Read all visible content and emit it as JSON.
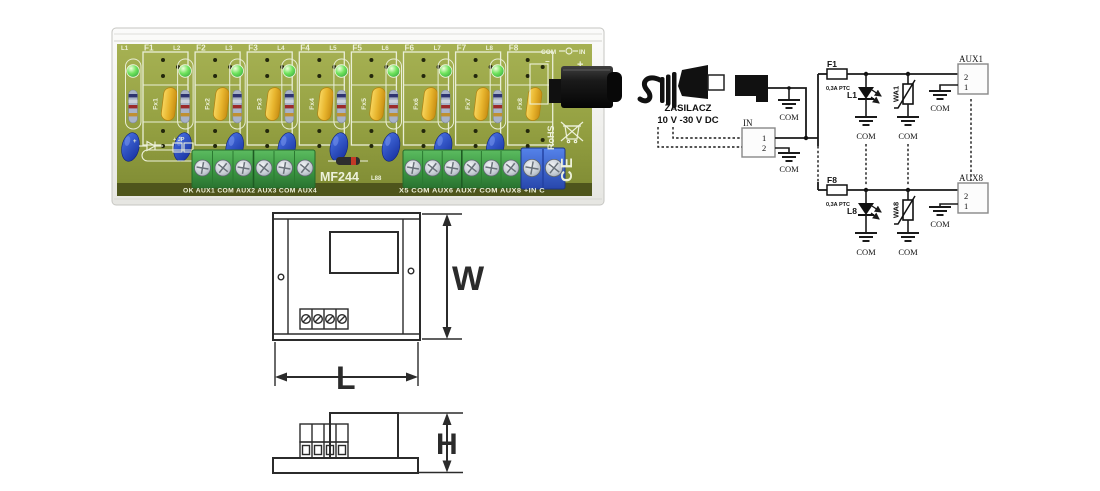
{
  "pcb": {
    "channels": [
      {
        "f": "F1",
        "l": "L1",
        "fx": "Fx1"
      },
      {
        "f": "F2",
        "l": "L2",
        "fx": "Fx2"
      },
      {
        "f": "F3",
        "l": "L3",
        "fx": "Fx3"
      },
      {
        "f": "F4",
        "l": "L4",
        "fx": "Fx4"
      },
      {
        "f": "F5",
        "l": "L5",
        "fx": "Fx5"
      },
      {
        "f": "F6",
        "l": "L6",
        "fx": "Fx6"
      },
      {
        "f": "F7",
        "l": "L7",
        "fx": "Fx7"
      },
      {
        "f": "F8",
        "l": "L8",
        "fx": "Fx8"
      }
    ],
    "power_header": {
      "com": "COM",
      "in": "IN",
      "minus": "−",
      "plus": "+"
    },
    "silk_left_labels": "OK AUX1 COM AUX2 AUX3 COM AUX4",
    "silk_right_labels": "X5 COM AUX6 AUX7 COM AUX8 +IN C",
    "model": "MF244",
    "code": "L88",
    "jumper_label": "+ JP",
    "diode_plus": "+",
    "rohs": "RoHS",
    "ce_mark": "CE"
  },
  "dimensions": {
    "width_label": "W",
    "length_label": "L",
    "height_label": "H"
  },
  "schematic": {
    "psu_line1": "ZASILACZ",
    "psu_line2": "10 V -30 V DC",
    "in_label": "IN",
    "in_pin1": "1",
    "in_pin2": "2",
    "com": "COM",
    "branch1": {
      "fuse": "F1",
      "rating": "0,3A PTC",
      "led": "L1",
      "varistor": "WA1",
      "aux": "AUX1",
      "pin2": "2",
      "pin1": "1"
    },
    "branch8": {
      "fuse": "F8",
      "rating": "0,3A PTC",
      "led": "L8",
      "varistor": "WA8",
      "aux": "AUX8",
      "pin2": "2",
      "pin1": "1"
    }
  }
}
